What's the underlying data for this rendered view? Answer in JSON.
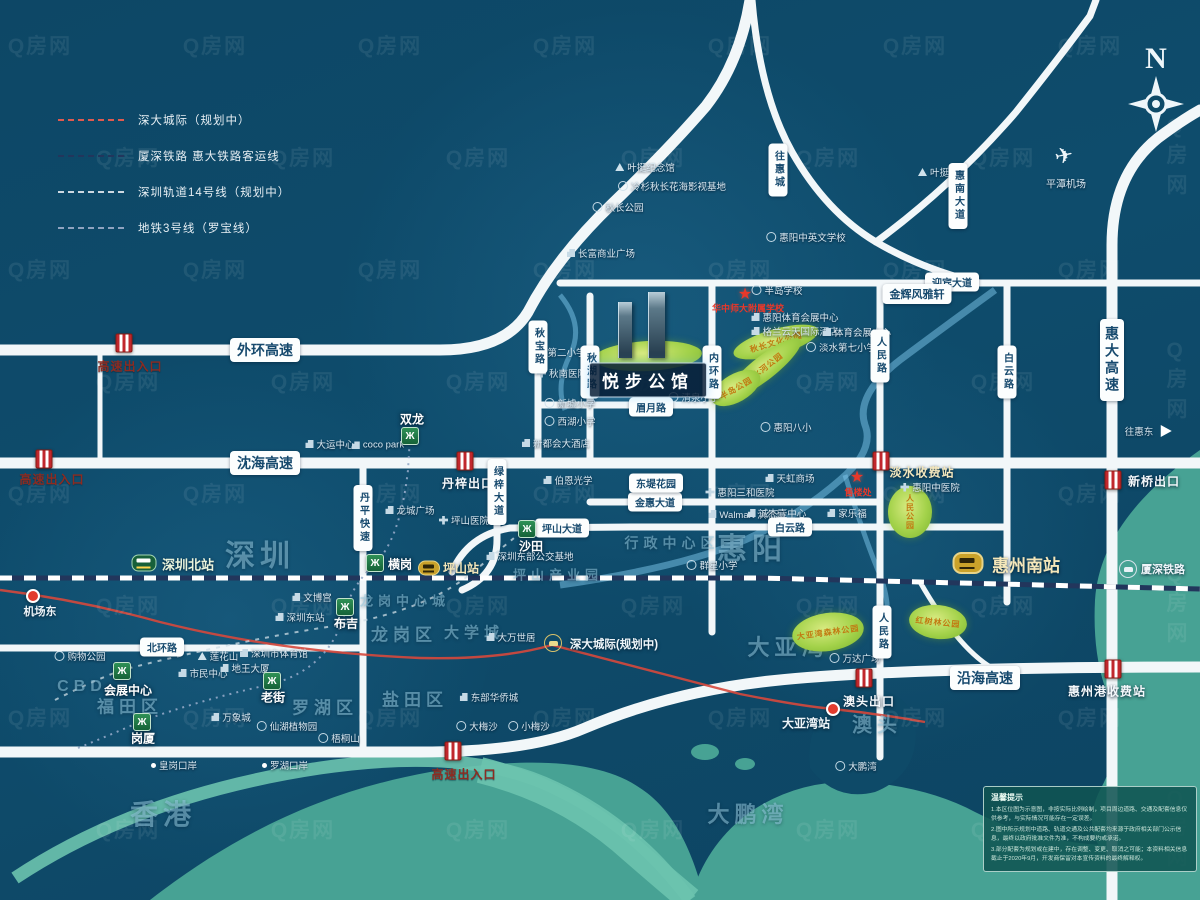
{
  "watermark": {
    "text": "Q房网"
  },
  "compass": {
    "label": "N"
  },
  "legend": {
    "items": [
      {
        "label": "深大城际（规划中）",
        "color": "#e05a4e"
      },
      {
        "label": "厦深铁路 惠大铁路客运线",
        "color": "#22365c"
      },
      {
        "label": "深圳轨道14号线（规划中）",
        "color": "#cdd9e2"
      },
      {
        "label": "地铁3号线（罗宝线）",
        "color": "#8fa3c0"
      }
    ]
  },
  "project": {
    "name": "悦步公馆"
  },
  "regions": [
    {
      "t": "深圳",
      "x": 260,
      "y": 553,
      "fs": 30
    },
    {
      "t": "香港",
      "x": 163,
      "y": 813,
      "fs": 28
    },
    {
      "t": "惠阳",
      "x": 752,
      "y": 546,
      "fs": 30
    },
    {
      "t": "大亚湾",
      "x": 788,
      "y": 646,
      "fs": 22
    },
    {
      "t": "澳头",
      "x": 877,
      "y": 723,
      "fs": 20
    },
    {
      "t": "大鹏湾",
      "x": 748,
      "y": 813,
      "fs": 22
    },
    {
      "t": "CBD",
      "x": 82,
      "y": 687,
      "fs": 16
    },
    {
      "t": "福田区",
      "x": 130,
      "y": 705,
      "fs": 17
    },
    {
      "t": "罗湖区",
      "x": 325,
      "y": 706,
      "fs": 17
    },
    {
      "t": "盐田区",
      "x": 415,
      "y": 698,
      "fs": 17
    },
    {
      "t": "龙岗区",
      "x": 404,
      "y": 633,
      "fs": 17
    },
    {
      "t": "龙岗中心城",
      "x": 405,
      "y": 600,
      "fs": 13
    },
    {
      "t": "大学城",
      "x": 474,
      "y": 632,
      "fs": 15
    },
    {
      "t": "坪山产业园",
      "x": 558,
      "y": 574,
      "fs": 13
    },
    {
      "t": "行政中心区",
      "x": 672,
      "y": 543,
      "fs": 14
    }
  ],
  "road_labels": [
    {
      "t": "外环高速",
      "x": 265,
      "y": 350,
      "fs": 14
    },
    {
      "t": "沈海高速",
      "x": 265,
      "y": 463,
      "fs": 14
    },
    {
      "t": "沿海高速",
      "x": 985,
      "y": 678,
      "fs": 14
    },
    {
      "t": "惠大高速",
      "x": 1112,
      "y": 360,
      "fs": 14,
      "v": 1
    },
    {
      "t": "北环路",
      "x": 162,
      "y": 647,
      "fs": 10
    },
    {
      "t": "丹平快速",
      "x": 363,
      "y": 518,
      "fs": 10,
      "v": 1
    },
    {
      "t": "绿梓大道",
      "x": 497,
      "y": 492,
      "fs": 10,
      "v": 1
    },
    {
      "t": "坪山大道",
      "x": 562,
      "y": 528,
      "fs": 10
    },
    {
      "t": "金惠大道",
      "x": 655,
      "y": 502,
      "fs": 10
    },
    {
      "t": "白云路",
      "x": 790,
      "y": 527,
      "fs": 10
    },
    {
      "t": "白云路",
      "x": 1007,
      "y": 372,
      "fs": 10,
      "v": 1
    },
    {
      "t": "人民路",
      "x": 880,
      "y": 356,
      "fs": 10,
      "v": 1
    },
    {
      "t": "人民路",
      "x": 882,
      "y": 632,
      "fs": 10,
      "v": 1
    },
    {
      "t": "内环路",
      "x": 712,
      "y": 372,
      "fs": 10,
      "v": 1
    },
    {
      "t": "秋湖路",
      "x": 590,
      "y": 372,
      "fs": 10,
      "v": 1
    },
    {
      "t": "秋宝路",
      "x": 538,
      "y": 347,
      "fs": 10,
      "v": 1
    },
    {
      "t": "眉月路",
      "x": 651,
      "y": 407,
      "fs": 10
    },
    {
      "t": "迎宾大道",
      "x": 952,
      "y": 282,
      "fs": 10
    },
    {
      "t": "惠南大道",
      "x": 958,
      "y": 196,
      "fs": 10,
      "v": 1
    },
    {
      "t": "往惠城",
      "x": 778,
      "y": 170,
      "fs": 10,
      "v": 1
    },
    {
      "t": "金辉风雅轩",
      "x": 917,
      "y": 294,
      "fs": 11
    },
    {
      "t": "东堤花园",
      "x": 656,
      "y": 483,
      "fs": 10
    }
  ],
  "exits": [
    {
      "t": "高速出入口",
      "x": 130,
      "y": 366,
      "ix": 124,
      "iy": 343,
      "k": "red"
    },
    {
      "t": "高速出入口",
      "x": 52,
      "y": 479,
      "ix": 44,
      "iy": 459,
      "k": "red"
    },
    {
      "t": "高速出入口",
      "x": 464,
      "y": 774,
      "ix": 453,
      "iy": 751,
      "k": "red"
    },
    {
      "t": "丹梓出口",
      "x": 468,
      "y": 483,
      "ix": 465,
      "iy": 461,
      "k": "white"
    },
    {
      "t": "淡水收费站",
      "x": 922,
      "y": 472,
      "ix": 881,
      "iy": 461,
      "k": "cream"
    },
    {
      "t": "新桥出口",
      "x": 1154,
      "y": 481,
      "ix": 1113,
      "iy": 480,
      "k": "white"
    },
    {
      "t": "澳头出口",
      "x": 869,
      "y": 701,
      "ix": 864,
      "iy": 678,
      "k": "white"
    },
    {
      "t": "惠州港收费站",
      "x": 1107,
      "y": 691,
      "ix": 1113,
      "iy": 669,
      "k": "white"
    }
  ],
  "stations": [
    {
      "t": "深圳北站",
      "x": 188,
      "y": 564,
      "ic": "train-g",
      "ix": 144,
      "iy": 563,
      "cls": "g",
      "fs": 13
    },
    {
      "t": "坪山站",
      "x": 461,
      "y": 568,
      "ic": "train-y sm",
      "ix": 429,
      "iy": 568,
      "cls": "y",
      "fs": 12
    },
    {
      "t": "惠州南站",
      "x": 1026,
      "y": 564,
      "ic": "train-y",
      "ix": 968,
      "iy": 563,
      "cls": "y",
      "fs": 17
    },
    {
      "t": "厦深铁路",
      "x": 1163,
      "y": 569,
      "ic": "train-c w",
      "ix": 1128,
      "iy": 569,
      "cls": "w",
      "fs": 11
    },
    {
      "t": "深大城际(规划中)",
      "x": 614,
      "y": 644,
      "ic": "train-c",
      "ix": 553,
      "iy": 643,
      "cls": "w",
      "fs": 11.5
    },
    {
      "t": "大亚湾站",
      "x": 806,
      "y": 723,
      "ic": "dot-red",
      "ix": 833,
      "iy": 709,
      "cls": "w",
      "fs": 12
    },
    {
      "t": "机场东",
      "x": 40,
      "y": 611,
      "ic": "dot-red",
      "ix": 33,
      "iy": 596,
      "cls": "w",
      "fs": 11
    }
  ],
  "metro_stations": [
    {
      "t": "双龙",
      "x": 412,
      "y": 419,
      "ix": 410,
      "iy": 436
    },
    {
      "t": "横岗",
      "x": 400,
      "y": 564,
      "ix": 375,
      "iy": 563
    },
    {
      "t": "布吉",
      "x": 346,
      "y": 623,
      "ix": 345,
      "iy": 607
    },
    {
      "t": "沙田",
      "x": 531,
      "y": 546,
      "ix": 527,
      "iy": 529
    },
    {
      "t": "老街",
      "x": 273,
      "y": 697,
      "ix": 272,
      "iy": 681
    },
    {
      "t": "会展中心",
      "x": 128,
      "y": 690,
      "ix": 122,
      "iy": 671
    },
    {
      "t": "岗厦",
      "x": 143,
      "y": 738,
      "ix": 142,
      "iy": 722
    }
  ],
  "pois": [
    {
      "t": "叶挺纪念馆",
      "x": 645,
      "y": 167,
      "i": "mon"
    },
    {
      "t": "冷杉秋长花海影视基地",
      "x": 672,
      "y": 186,
      "i": "school"
    },
    {
      "t": "秋长公园",
      "x": 618,
      "y": 207,
      "i": "school"
    },
    {
      "t": "长富商业广场",
      "x": 601,
      "y": 253,
      "i": "bld"
    },
    {
      "t": "惠阳中英文学校",
      "x": 806,
      "y": 237,
      "i": "school"
    },
    {
      "t": "叶挺故居",
      "x": 943,
      "y": 172,
      "i": "mon"
    },
    {
      "t": "半岛学校",
      "x": 777,
      "y": 290,
      "i": "school"
    },
    {
      "t": "惠阳体育会展中心",
      "x": 795,
      "y": 317,
      "i": "bld"
    },
    {
      "t": "格兰云天国际酒店",
      "x": 795,
      "y": 331,
      "i": "bld"
    },
    {
      "t": "体育会展中心",
      "x": 857,
      "y": 332,
      "i": "bld"
    },
    {
      "t": "淡水第七小学",
      "x": 841,
      "y": 347,
      "i": "school"
    },
    {
      "t": "惠阳八小",
      "x": 786,
      "y": 427,
      "i": "school"
    },
    {
      "t": "清泉小学",
      "x": 694,
      "y": 397,
      "i": "school"
    },
    {
      "t": "第二小学",
      "x": 560,
      "y": 352,
      "i": "school"
    },
    {
      "t": "秋南医院",
      "x": 562,
      "y": 373,
      "i": "hosp"
    },
    {
      "t": "新墟小学",
      "x": 570,
      "y": 403,
      "i": "school"
    },
    {
      "t": "西湖小学",
      "x": 570,
      "y": 421,
      "i": "school"
    },
    {
      "t": "新都会大酒店",
      "x": 556,
      "y": 443,
      "i": "bld"
    },
    {
      "t": "伯恩光学",
      "x": 568,
      "y": 480,
      "i": "bld"
    },
    {
      "t": "惠阳三和医院",
      "x": 740,
      "y": 492,
      "i": "hosp"
    },
    {
      "t": "Walmart 沃尔玛",
      "x": 747,
      "y": 514,
      "i": "bld"
    },
    {
      "t": "天虹商场",
      "x": 790,
      "y": 478,
      "i": "bld"
    },
    {
      "t": "诚杰壹中心",
      "x": 777,
      "y": 513,
      "i": "bld"
    },
    {
      "t": "家乐福",
      "x": 847,
      "y": 513,
      "i": "bld"
    },
    {
      "t": "群星小学",
      "x": 712,
      "y": 565,
      "i": "school"
    },
    {
      "t": "惠阳中医院",
      "x": 930,
      "y": 487,
      "i": "hosp"
    },
    {
      "t": "万达广场",
      "x": 855,
      "y": 658,
      "i": "school"
    },
    {
      "t": "大鹏湾",
      "x": 856,
      "y": 766,
      "i": "school"
    },
    {
      "t": "皇岗口岸",
      "x": 174,
      "y": 765,
      "i": "dotw"
    },
    {
      "t": "罗湖口岸",
      "x": 285,
      "y": 765,
      "i": "dotw"
    },
    {
      "t": "购物公园",
      "x": 80,
      "y": 656,
      "i": "school"
    },
    {
      "t": "莲花山",
      "x": 218,
      "y": 656,
      "i": "mon"
    },
    {
      "t": "市民中心",
      "x": 203,
      "y": 673,
      "i": "bld"
    },
    {
      "t": "地王大厦",
      "x": 245,
      "y": 668,
      "i": "bld"
    },
    {
      "t": "深圳市体育馆",
      "x": 274,
      "y": 653,
      "i": "bld"
    },
    {
      "t": "万象城",
      "x": 231,
      "y": 717,
      "i": "bld"
    },
    {
      "t": "仙湖植物园",
      "x": 287,
      "y": 726,
      "i": "school"
    },
    {
      "t": "梧桐山",
      "x": 339,
      "y": 738,
      "i": "school"
    },
    {
      "t": "文博宫",
      "x": 312,
      "y": 597,
      "i": "bld"
    },
    {
      "t": "深圳东站",
      "x": 300,
      "y": 617,
      "i": "bld"
    },
    {
      "t": "大万世居",
      "x": 511,
      "y": 637,
      "i": "bld"
    },
    {
      "t": "东部华侨城",
      "x": 489,
      "y": 697,
      "i": "bld"
    },
    {
      "t": "大梅沙",
      "x": 477,
      "y": 726,
      "i": "school"
    },
    {
      "t": "小梅沙",
      "x": 529,
      "y": 726,
      "i": "school"
    },
    {
      "t": "大运中心",
      "x": 330,
      "y": 444,
      "i": "bld"
    },
    {
      "t": "coco park",
      "x": 378,
      "y": 445,
      "i": "bld"
    },
    {
      "t": "龙城广场",
      "x": 410,
      "y": 510,
      "i": "bld"
    },
    {
      "t": "坪山医院",
      "x": 464,
      "y": 520,
      "i": "hosp"
    },
    {
      "t": "深圳东部公交基地",
      "x": 530,
      "y": 556,
      "i": "bld"
    },
    {
      "t": "往惠东",
      "x": 1148,
      "y": 431,
      "i": "arrow"
    }
  ],
  "marks": [
    {
      "t": "★",
      "x": 745,
      "y": 294,
      "cls": "star"
    },
    {
      "t": "华中师大附属学校",
      "x": 748,
      "y": 308,
      "cls": "redtext"
    },
    {
      "t": "★",
      "x": 857,
      "y": 477,
      "cls": "star"
    },
    {
      "t": "售楼处",
      "x": 858,
      "y": 492,
      "cls": "redtext"
    },
    {
      "t": "✈",
      "x": 1064,
      "y": 156,
      "cls": "plane"
    },
    {
      "t": "平潭机场",
      "x": 1066,
      "y": 183,
      "cls": "airport-name"
    }
  ],
  "parks": [
    {
      "t": "",
      "x": 648,
      "y": 356,
      "w": 108,
      "h": 30,
      "r": -3
    },
    {
      "t": "秋长文化公园",
      "x": 776,
      "y": 342,
      "w": 88,
      "h": 26,
      "r": -16
    },
    {
      "t": "淡水河公园",
      "x": 764,
      "y": 368,
      "w": 92,
      "h": 24,
      "r": -38
    },
    {
      "t": "半岛公园",
      "x": 736,
      "y": 388,
      "w": 54,
      "h": 28,
      "r": -30
    },
    {
      "t": "人民公园",
      "x": 910,
      "y": 512,
      "w": 44,
      "h": 52,
      "r": 0,
      "v": 1
    },
    {
      "t": "大亚湾森林公园",
      "x": 828,
      "y": 632,
      "w": 72,
      "h": 38,
      "r": -8
    },
    {
      "t": "红树林公园",
      "x": 938,
      "y": 622,
      "w": 58,
      "h": 34,
      "r": 6
    }
  ],
  "notice": {
    "title": "温馨提示",
    "lines": [
      "1.本区位图为示意图，非按实际比例绘制，项目周边道路、交通及配套信息仅供参考，与实际情况可能存在一定误差。",
      "2.图中所示规划中道路、轨道交通及公共配套均来源于政府相关部门公示信息，最终以政府批准文件为准，不构成要约或承诺。",
      "3.部分配套为规划或在建中，存在调整、变更、取消之可能；本资料相关信息截止于2020年9月，开发商保留对本宣传资料的最终解释权。"
    ]
  }
}
